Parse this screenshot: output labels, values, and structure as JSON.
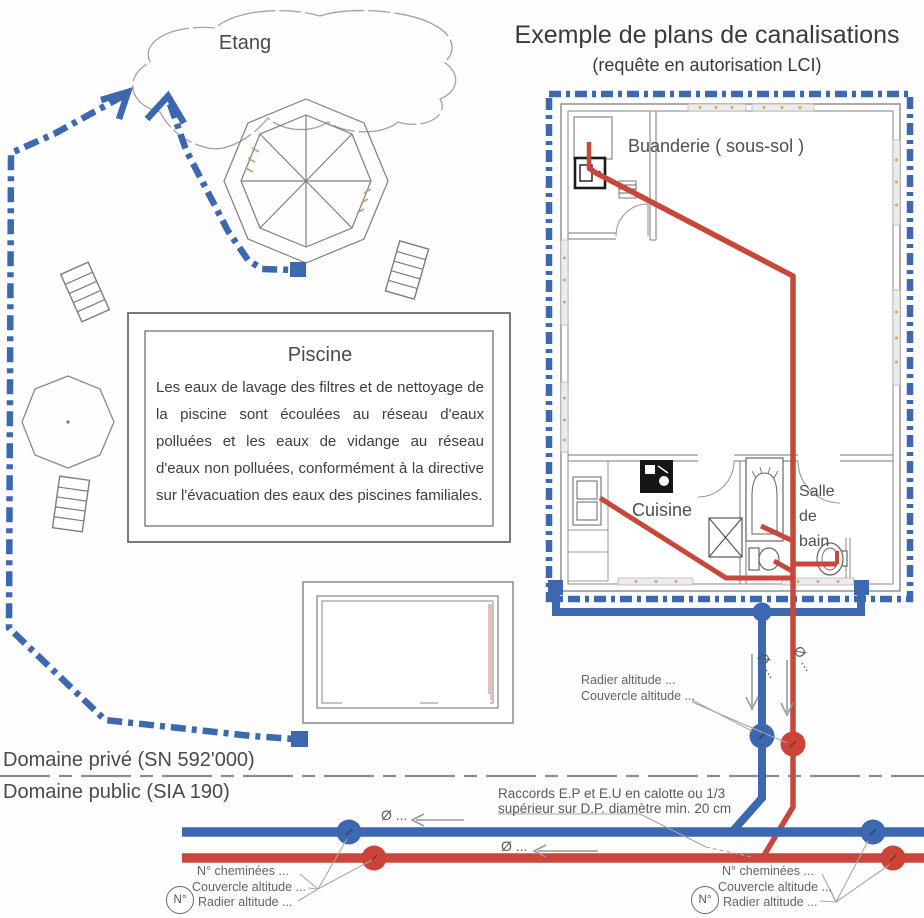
{
  "title": {
    "main": "Exemple de plans de canalisations",
    "subtitle": "(requête en autorisation LCI)"
  },
  "labels": {
    "pond": "Etang",
    "piscine_title": "Piscine",
    "piscine_text": "Les eaux de lavage des filtres et de nettoyage de la piscine sont écoulées au réseau d'eaux polluées et les eaux de vidange au réseau d'eaux non polluées, conformément à la directive sur l'évacuation des eaux des piscines familiales.",
    "rooms": {
      "buanderie": "Buanderie ( sous-sol )",
      "cuisine": "Cuisine",
      "bath1": "Salle",
      "bath2": "de",
      "bath3": "bain"
    },
    "boundary": {
      "private": "Domaine privé (SN 592'000)",
      "public": "Domaine public (SIA 190)"
    },
    "pipes": {
      "radier": "Radier altitude ...",
      "couvercle": "Couvercle altitude ...",
      "raccords1": "Raccords E.P et E.U en calotte ou 1/3",
      "raccords2": "supérieur sur D.P. diamètre min. 20 cm",
      "dia": "Ø ..."
    },
    "manholes": {
      "badge": "N°",
      "chimneys": "N° cheminées ...",
      "cover": "Couvercle altitude ...",
      "invert": "Radier altitude ..."
    }
  },
  "colors": {
    "pipe_blue": "#3c68b0",
    "pipe_red": "#c7473a",
    "wall_grey": "#909090",
    "text_dark": "#3a3a3a",
    "text_grey": "#646464",
    "window_dot": "#d9a35a"
  }
}
